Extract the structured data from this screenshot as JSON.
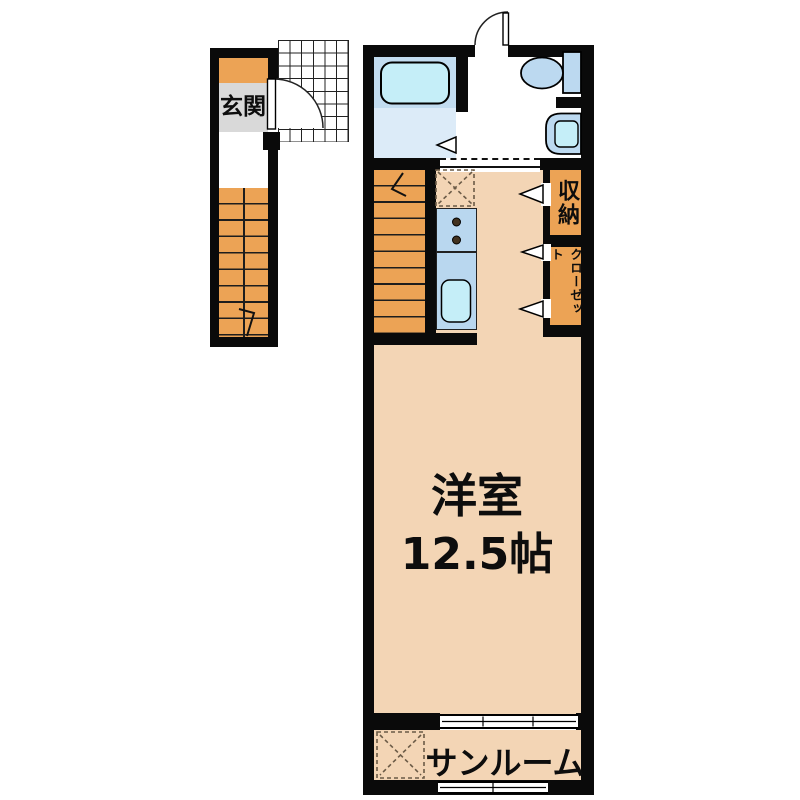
{
  "floorplan": {
    "labels": {
      "entrance": "玄関",
      "room_name": "洋室",
      "room_size": "12.5帖",
      "storage": "収納",
      "closet": "クローゼット",
      "sunroom": "サンルーム"
    },
    "colors": {
      "wall": "#0a0a0a",
      "wood": "#eca355",
      "room": "#f3d5b5",
      "entrance_gray": "#d9d9d9",
      "bath_top": "#c2dcf0",
      "bath_floor": "#dcebf8",
      "fixture_blue": "#bcd9f0",
      "water_cyan": "#c5eef8",
      "counter_blue": "#b9d7ef",
      "dash_brown": "#6b5b47"
    }
  }
}
